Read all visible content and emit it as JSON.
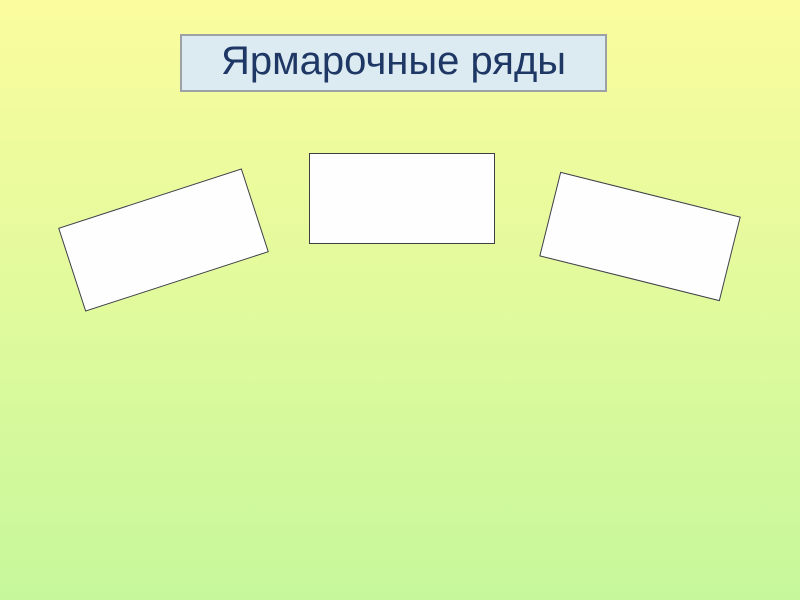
{
  "slide": {
    "title": "Ярмарочные ряды"
  },
  "colors": {
    "background_top": "#fbfc9e",
    "background_bottom": "#c6f89b",
    "title_fill": "#dcebf2",
    "title_border": "#9ba1a5",
    "title_text": "#1e3764",
    "card_fill": "#fefefe",
    "card_border": "#3c4043"
  },
  "cards": [
    {
      "name": "fair-stall-card-left"
    },
    {
      "name": "fair-stall-card-middle"
    },
    {
      "name": "fair-stall-card-right"
    }
  ]
}
